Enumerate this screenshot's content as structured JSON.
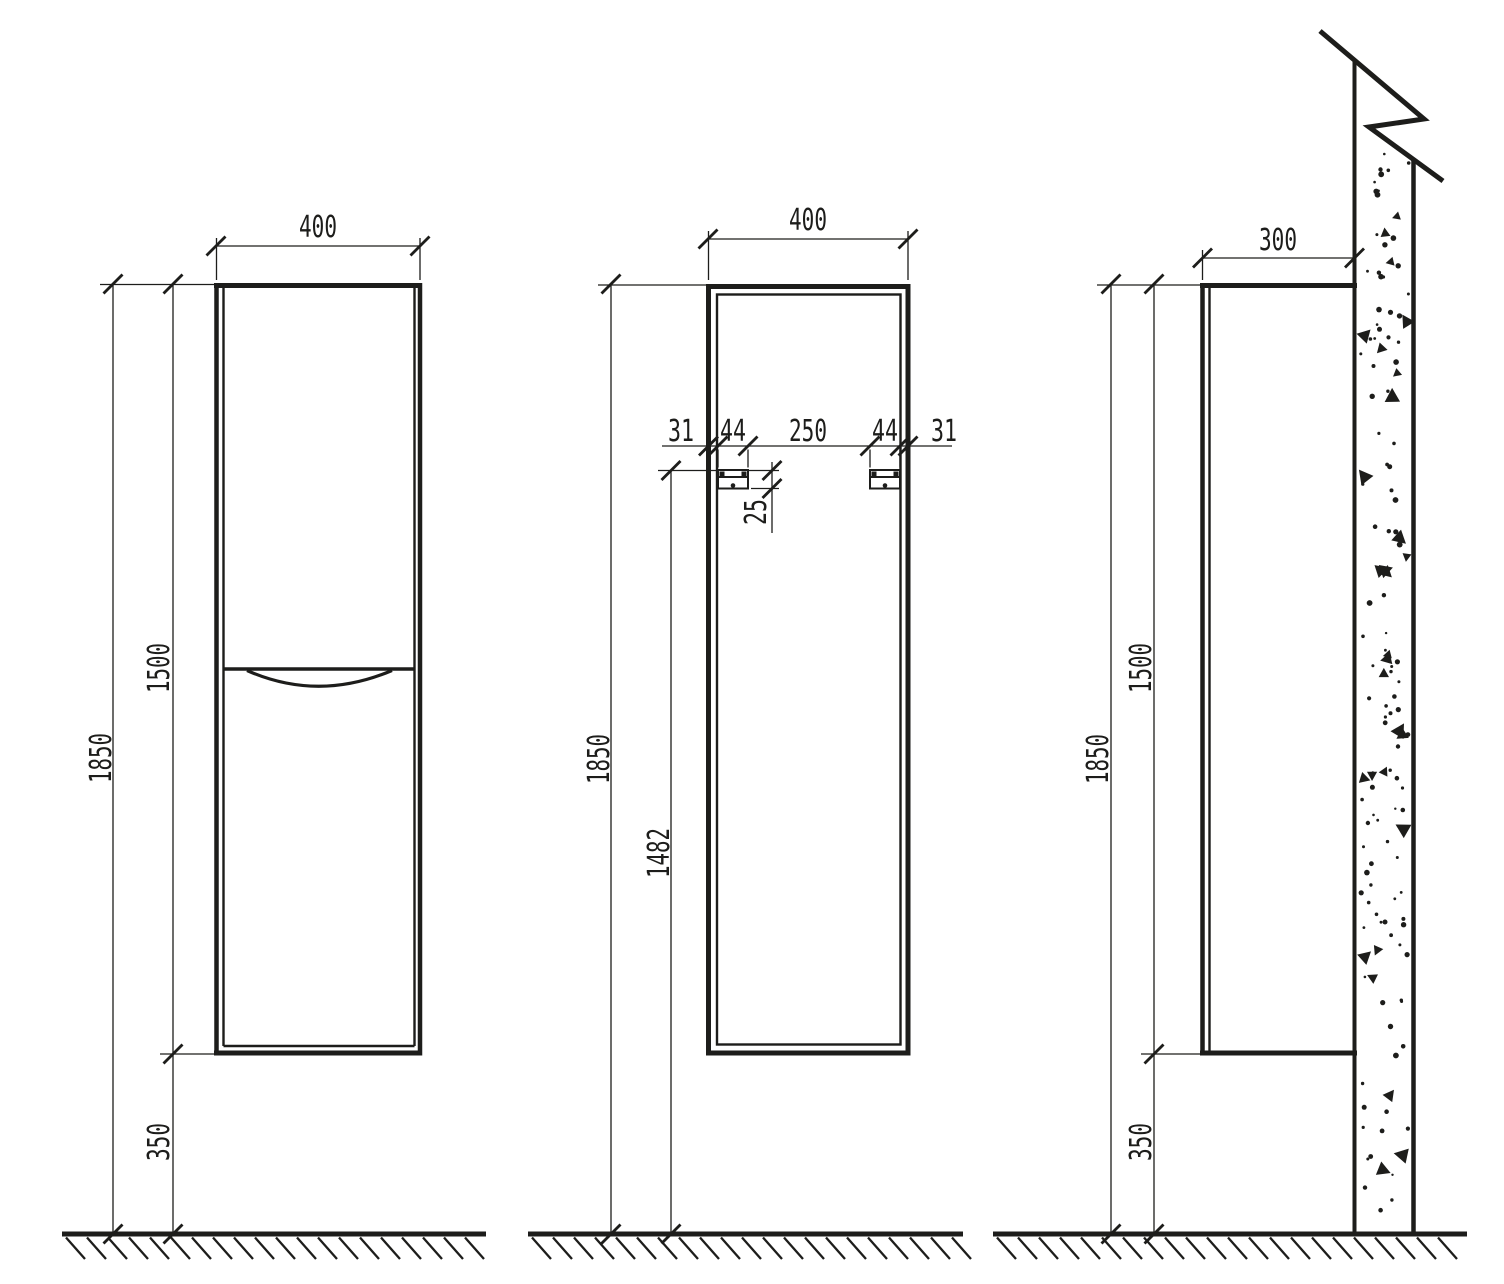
{
  "drawing": {
    "type": "technical-drawing",
    "subject": "wall-hung tall cabinet, three orthographic views",
    "line_color": "#1d1d1b",
    "background": "#ffffff",
    "views": {
      "front": {
        "width": "400",
        "overall_height": "1850",
        "cabinet_height": "1500",
        "floor_clearance": "350"
      },
      "back": {
        "width": "400",
        "overall_height": "1850",
        "bracket_mount_height": "1482",
        "bracket_plate_height": "25",
        "top_dims": [
          "31",
          "44",
          "250",
          "44",
          "31"
        ]
      },
      "side": {
        "depth": "300",
        "overall_height": "1850",
        "cabinet_height": "1500",
        "floor_clearance": "350"
      }
    }
  }
}
